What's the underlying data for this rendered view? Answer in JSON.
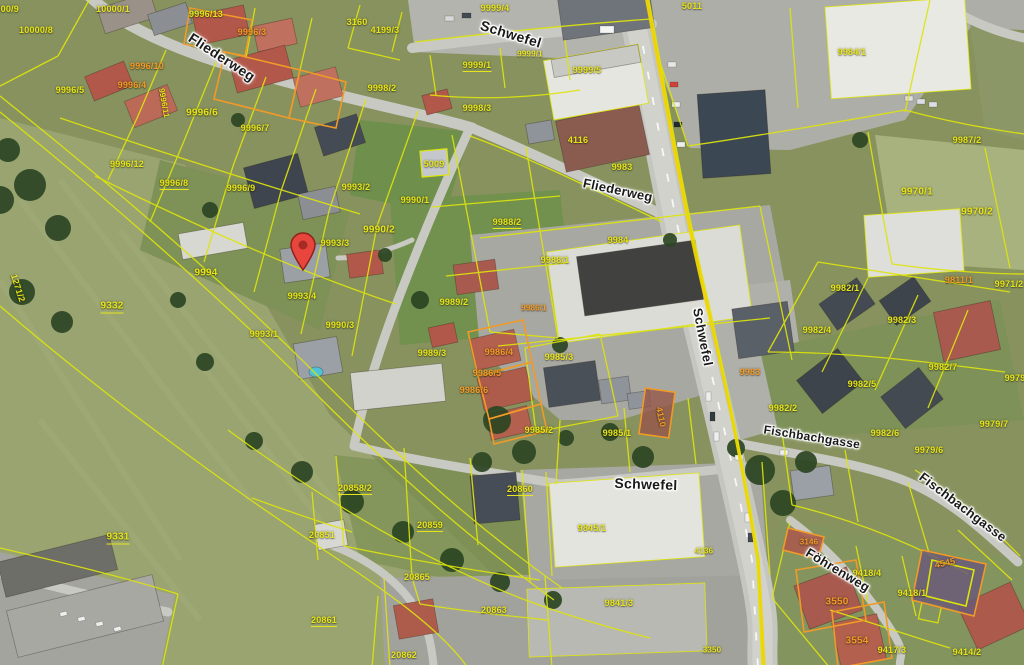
{
  "map": {
    "type": "cadastral-aerial-map",
    "colors": {
      "parcel_line": "#dde40c",
      "label_yellow": "#e6e41a",
      "label_orange": "#f49a28",
      "street_text": "#1a1a1a",
      "road_stripe": "#f0d400",
      "marker": "#e8453c"
    },
    "street_labels": [
      {
        "t": "Fliederweg",
        "x": 222,
        "y": 57,
        "r": 33,
        "s": 14
      },
      {
        "t": "Schwefel",
        "x": 511,
        "y": 34,
        "r": 17,
        "s": 14
      },
      {
        "t": "Fliederweg",
        "x": 618,
        "y": 190,
        "r": 12,
        "s": 13
      },
      {
        "t": "Schwefel",
        "x": 703,
        "y": 337,
        "r": 79,
        "s": 13
      },
      {
        "t": "Schwefel",
        "x": 646,
        "y": 484,
        "r": 2,
        "s": 14
      },
      {
        "t": "Fischbachgasse",
        "x": 812,
        "y": 437,
        "r": 9,
        "s": 12
      },
      {
        "t": "Fischbachgasse",
        "x": 963,
        "y": 507,
        "r": 37,
        "s": 13
      },
      {
        "t": "Föhrenweg",
        "x": 838,
        "y": 570,
        "r": 31,
        "s": 13
      }
    ],
    "parcel_labels": [
      {
        "t": "10000/9",
        "x": 2,
        "y": 9
      },
      {
        "t": "10000/1",
        "x": 113,
        "y": 9
      },
      {
        "t": "10000/8",
        "x": 36,
        "y": 30
      },
      {
        "t": "9996/13",
        "x": 206,
        "y": 14
      },
      {
        "t": "9996/3",
        "x": 252,
        "y": 32,
        "c": "o"
      },
      {
        "t": "3160",
        "x": 357,
        "y": 22
      },
      {
        "t": "4199/3",
        "x": 385,
        "y": 30
      },
      {
        "t": "9999/4",
        "x": 495,
        "y": 8
      },
      {
        "t": "5011",
        "x": 692,
        "y": 6
      },
      {
        "t": "9984/1",
        "x": 852,
        "y": 52
      },
      {
        "t": "9996/10",
        "x": 147,
        "y": 66,
        "c": "o"
      },
      {
        "t": "9996/4",
        "x": 132,
        "y": 85,
        "c": "o"
      },
      {
        "t": "9996/5",
        "x": 70,
        "y": 90
      },
      {
        "t": "9996/6",
        "x": 202,
        "y": 113,
        "s": 10
      },
      {
        "t": "9996/11",
        "x": 164,
        "y": 103,
        "r": 80,
        "s": 8
      },
      {
        "t": "9996/7",
        "x": 255,
        "y": 128
      },
      {
        "t": "9996/12",
        "x": 127,
        "y": 164
      },
      {
        "t": "9996/8",
        "x": 174,
        "y": 184,
        "u": 1
      },
      {
        "t": "9996/9",
        "x": 241,
        "y": 188
      },
      {
        "t": "9999/1",
        "x": 530,
        "y": 54,
        "s": 8
      },
      {
        "t": "9999/1",
        "x": 477,
        "y": 66,
        "u": 1
      },
      {
        "t": "9999/5",
        "x": 587,
        "y": 70
      },
      {
        "t": "9998/2",
        "x": 382,
        "y": 88
      },
      {
        "t": "9998/3",
        "x": 477,
        "y": 108
      },
      {
        "t": "4116",
        "x": 578,
        "y": 140
      },
      {
        "t": "9983",
        "x": 622,
        "y": 167
      },
      {
        "t": "9987/2",
        "x": 967,
        "y": 140
      },
      {
        "t": "9970/1",
        "x": 917,
        "y": 192,
        "s": 10
      },
      {
        "t": "9970/2",
        "x": 977,
        "y": 212,
        "s": 10
      },
      {
        "t": "9993/2",
        "x": 356,
        "y": 187
      },
      {
        "t": "9990/1",
        "x": 415,
        "y": 200
      },
      {
        "t": "5009",
        "x": 434,
        "y": 164
      },
      {
        "t": "9990/2",
        "x": 379,
        "y": 230,
        "s": 10
      },
      {
        "t": "9993/3",
        "x": 335,
        "y": 243
      },
      {
        "t": "9994",
        "x": 206,
        "y": 273,
        "s": 10
      },
      {
        "t": "9988/2",
        "x": 507,
        "y": 223,
        "u": 1
      },
      {
        "t": "9988/1",
        "x": 555,
        "y": 260
      },
      {
        "t": "9984",
        "x": 618,
        "y": 240
      },
      {
        "t": "9993/4",
        "x": 302,
        "y": 296
      },
      {
        "t": "9989/2",
        "x": 454,
        "y": 302
      },
      {
        "t": "9986/1",
        "x": 534,
        "y": 308,
        "c": "o",
        "s": 8
      },
      {
        "t": "9332",
        "x": 112,
        "y": 307,
        "s": 10,
        "u": 1
      },
      {
        "t": "1271/2",
        "x": 18,
        "y": 288,
        "r": 72
      },
      {
        "t": "9990/3",
        "x": 340,
        "y": 325
      },
      {
        "t": "9993/1",
        "x": 264,
        "y": 334
      },
      {
        "t": "9989/3",
        "x": 432,
        "y": 353
      },
      {
        "t": "9986/4",
        "x": 499,
        "y": 352,
        "c": "o"
      },
      {
        "t": "9985/3",
        "x": 559,
        "y": 357
      },
      {
        "t": "9986/5",
        "x": 487,
        "y": 373,
        "c": "o"
      },
      {
        "t": "9986/6",
        "x": 474,
        "y": 390,
        "c": "o"
      },
      {
        "t": "9982/7",
        "x": 943,
        "y": 367
      },
      {
        "t": "9982/4",
        "x": 817,
        "y": 330
      },
      {
        "t": "9982/3",
        "x": 902,
        "y": 320
      },
      {
        "t": "9982/1",
        "x": 845,
        "y": 288
      },
      {
        "t": "9811/1",
        "x": 959,
        "y": 280,
        "c": "o"
      },
      {
        "t": "9971/2",
        "x": 1009,
        "y": 284
      },
      {
        "t": "9982/5",
        "x": 862,
        "y": 384
      },
      {
        "t": "9982/2",
        "x": 783,
        "y": 408
      },
      {
        "t": "9979",
        "x": 1015,
        "y": 378
      },
      {
        "t": "9982/6",
        "x": 885,
        "y": 433
      },
      {
        "t": "9979/7",
        "x": 994,
        "y": 424
      },
      {
        "t": "9979/6",
        "x": 929,
        "y": 450
      },
      {
        "t": "9983",
        "x": 750,
        "y": 372,
        "c": "o"
      },
      {
        "t": "9985/2",
        "x": 539,
        "y": 430
      },
      {
        "t": "9985/1",
        "x": 617,
        "y": 433
      },
      {
        "t": "4110",
        "x": 661,
        "y": 417,
        "c": "o",
        "r": 78
      },
      {
        "t": "20858/2",
        "x": 355,
        "y": 489,
        "u": 1
      },
      {
        "t": "20860",
        "x": 520,
        "y": 490,
        "u": 1
      },
      {
        "t": "20859",
        "x": 430,
        "y": 526,
        "u": 1
      },
      {
        "t": "20851",
        "x": 322,
        "y": 535
      },
      {
        "t": "9331",
        "x": 118,
        "y": 538,
        "s": 10,
        "u": 1
      },
      {
        "t": "20865",
        "x": 417,
        "y": 577
      },
      {
        "t": "20861",
        "x": 324,
        "y": 621,
        "u": 1
      },
      {
        "t": "20862",
        "x": 404,
        "y": 655
      },
      {
        "t": "20863",
        "x": 494,
        "y": 610
      },
      {
        "t": "9845/1",
        "x": 592,
        "y": 528
      },
      {
        "t": "9841/3",
        "x": 619,
        "y": 603
      },
      {
        "t": "4136",
        "x": 704,
        "y": 551,
        "s": 8
      },
      {
        "t": "3350",
        "x": 712,
        "y": 650,
        "s": 8
      },
      {
        "t": "3146",
        "x": 809,
        "y": 542,
        "c": "o",
        "s": 8
      },
      {
        "t": "3550",
        "x": 837,
        "y": 602,
        "c": "o",
        "s": 10
      },
      {
        "t": "9418/4",
        "x": 867,
        "y": 573
      },
      {
        "t": "9418/1",
        "x": 912,
        "y": 593
      },
      {
        "t": "4545",
        "x": 945,
        "y": 563,
        "c": "o",
        "r": -12
      },
      {
        "t": "3554",
        "x": 857,
        "y": 641,
        "c": "o",
        "s": 10
      },
      {
        "t": "9417/3",
        "x": 892,
        "y": 650
      },
      {
        "t": "9414/2",
        "x": 967,
        "y": 652
      }
    ],
    "marker": {
      "x": 303,
      "y": 272
    }
  }
}
